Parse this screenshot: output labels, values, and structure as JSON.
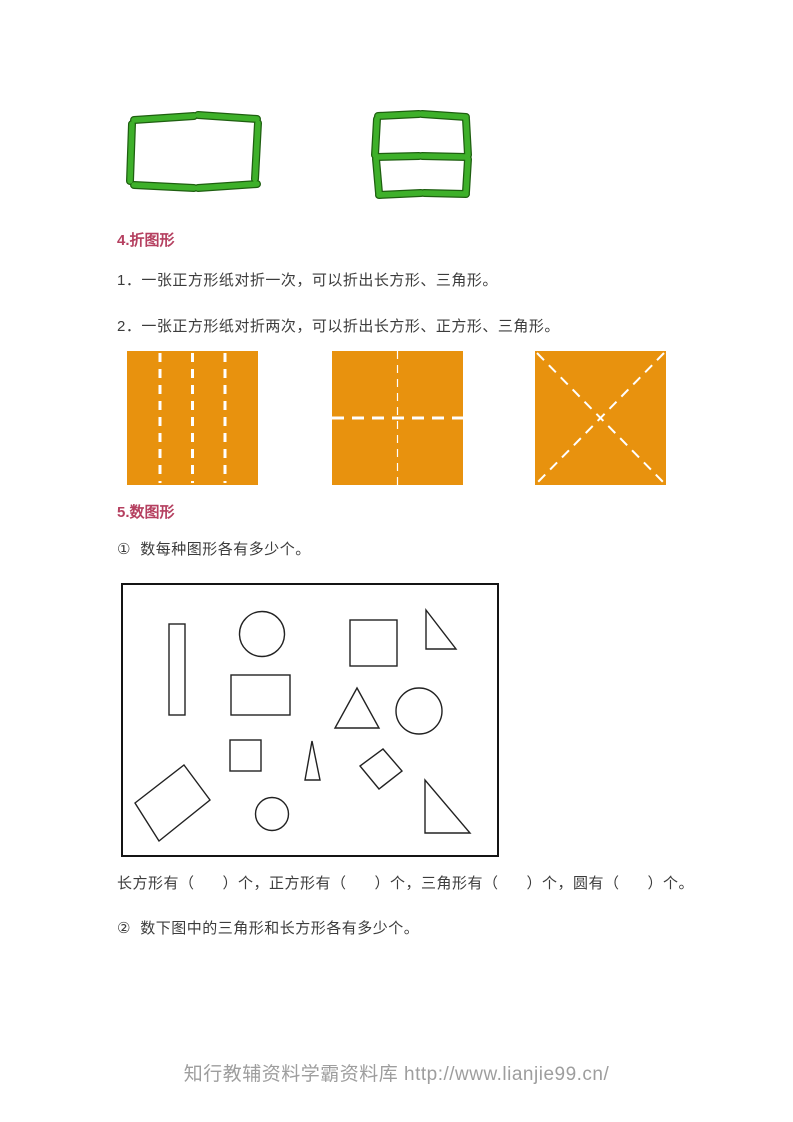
{
  "colors": {
    "heading": "#b5406c",
    "body_text": "#3c3c3c",
    "orange": "#e8920e",
    "fold_line": "#ffffff",
    "stick_green": "#3eb02a",
    "stick_edge": "#1e5f10",
    "shape_stroke": "#222222",
    "box_border": "#141414",
    "footer_gray": "#9e9e9e"
  },
  "sections": {
    "heading4": "4.折图形",
    "para1": "1．一张正方形纸对折一次，可以折出长方形、三角形。",
    "para2": "2．一张正方形纸对折两次，可以折出长方形、正方形、三角形。",
    "heading5": "5.数图形",
    "q1": "①  数每种图形各有多少个。",
    "answer_line": "长方形有（      ）个，正方形有（      ）个，三角形有（      ）个，圆有（      ）个。",
    "q2": "②  数下图中的三角形和长方形各有多少个。"
  },
  "footer": {
    "text": "知行教辅资料学霸资料库 http://www.lianjie99.cn/"
  },
  "stick_figures": {
    "left": {
      "name": "matchstick-rectangle",
      "sticks": [
        [
          10,
          14,
          70,
          10
        ],
        [
          74,
          9,
          133,
          13
        ],
        [
          134,
          17,
          131,
          73
        ],
        [
          8,
          18,
          6,
          75
        ],
        [
          10,
          79,
          70,
          82
        ],
        [
          74,
          82,
          133,
          78
        ]
      ]
    },
    "right": {
      "name": "matchstick-square-with-middle-bar",
      "sticks": [
        [
          12,
          13,
          53,
          11
        ],
        [
          56,
          11,
          100,
          14
        ],
        [
          11,
          16,
          9,
          52
        ],
        [
          10,
          56,
          13,
          90
        ],
        [
          100,
          16,
          102,
          52
        ],
        [
          102,
          56,
          100,
          89
        ],
        [
          10,
          54,
          53,
          53
        ],
        [
          56,
          53,
          101,
          54
        ],
        [
          13,
          92,
          55,
          90
        ],
        [
          58,
          90,
          100,
          91
        ]
      ]
    }
  },
  "fold_squares": [
    {
      "name": "vertical-fold-lines",
      "fold_lines": [
        {
          "x1": 33,
          "y1": 2,
          "x2": 33,
          "y2": 132,
          "w": 3,
          "dash": "9 7"
        },
        {
          "x1": 65.5,
          "y1": 2,
          "x2": 65.5,
          "y2": 132,
          "w": 3,
          "dash": "9 7"
        },
        {
          "x1": 98,
          "y1": 2,
          "x2": 98,
          "y2": 132,
          "w": 3,
          "dash": "9 7"
        }
      ]
    },
    {
      "name": "cross-fold-lines",
      "fold_lines": [
        {
          "x1": 0,
          "y1": 67,
          "x2": 131,
          "y2": 67,
          "w": 3,
          "dash": "12 8"
        },
        {
          "x1": 65.5,
          "y1": 0,
          "x2": 65.5,
          "y2": 134,
          "w": 1.2,
          "dash": "8 6"
        }
      ]
    },
    {
      "name": "diagonal-fold-lines",
      "fold_lines": [
        {
          "x1": 2,
          "y1": 2,
          "x2": 129,
          "y2": 132,
          "w": 2,
          "dash": "10 7"
        },
        {
          "x1": 129,
          "y1": 2,
          "x2": 2,
          "y2": 132,
          "w": 2,
          "dash": "10 7"
        }
      ]
    }
  ],
  "shapes_box": {
    "shapes": [
      {
        "type": "rect",
        "name": "tall-rectangle",
        "x": 46,
        "y": 39,
        "w": 16,
        "h": 91
      },
      {
        "type": "circle",
        "name": "circle-top",
        "cx": 139,
        "cy": 49,
        "r": 22.5
      },
      {
        "type": "rect",
        "name": "square-top",
        "x": 227,
        "y": 35,
        "w": 47,
        "h": 46
      },
      {
        "type": "polygon",
        "name": "right-triangle-top",
        "points": "303,25 303,64 333,64"
      },
      {
        "type": "rect",
        "name": "rectangle-middle",
        "x": 108,
        "y": 90,
        "w": 59,
        "h": 40
      },
      {
        "type": "polygon",
        "name": "triangle-middle",
        "points": "234,103 212,143 256,143"
      },
      {
        "type": "circle",
        "name": "circle-right",
        "cx": 296,
        "cy": 126,
        "r": 23
      },
      {
        "type": "rect",
        "name": "square-small",
        "x": 107,
        "y": 155,
        "w": 31,
        "h": 31
      },
      {
        "type": "polygon",
        "name": "triangle-narrow",
        "points": "189,156 182,195 197,195"
      },
      {
        "type": "polygon",
        "name": "diamond",
        "points": "260,164 279,186 256,204 237,181"
      },
      {
        "type": "circle",
        "name": "circle-small",
        "cx": 149,
        "cy": 229,
        "r": 16.5
      },
      {
        "type": "polygon",
        "name": "rectangle-rotated",
        "points": "61,180 87,215 36,256 12,218"
      },
      {
        "type": "polygon",
        "name": "right-triangle-bottom",
        "points": "302,195 302,248 347,248"
      }
    ]
  }
}
